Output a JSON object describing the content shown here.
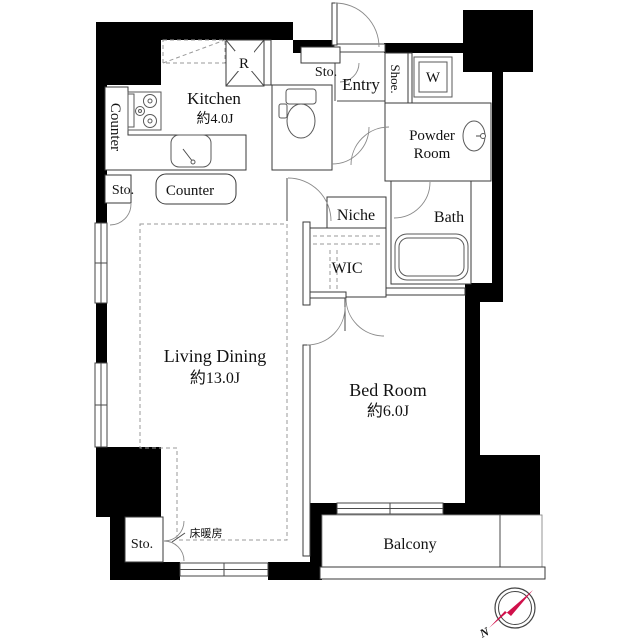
{
  "rooms": {
    "kitchen": {
      "name": "Kitchen",
      "size": "約4.0J"
    },
    "living": {
      "name": "Living Dining",
      "size": "約13.0J"
    },
    "bedroom": {
      "name": "Bed Room",
      "size": "約6.0J"
    },
    "bath": {
      "name": "Bath"
    },
    "powder": {
      "line1": "Powder",
      "line2": "Room"
    },
    "wic": {
      "name": "WIC"
    },
    "niche": {
      "name": "Niche"
    },
    "entry": {
      "name": "Entry"
    },
    "balcony": {
      "name": "Balcony"
    }
  },
  "labels": {
    "counter_side": "Counter",
    "counter_bottom": "Counter",
    "sto_entry": "Sto.",
    "sto_kitchen": "Sto.",
    "sto_living": "Sto.",
    "shoe": "Shoe.",
    "washer": "W",
    "fridge": "R",
    "floor_heating": "床暖房"
  },
  "compass": {
    "north": "N"
  },
  "colors": {
    "wall": "#000000",
    "compass_red": "#d0114b"
  }
}
